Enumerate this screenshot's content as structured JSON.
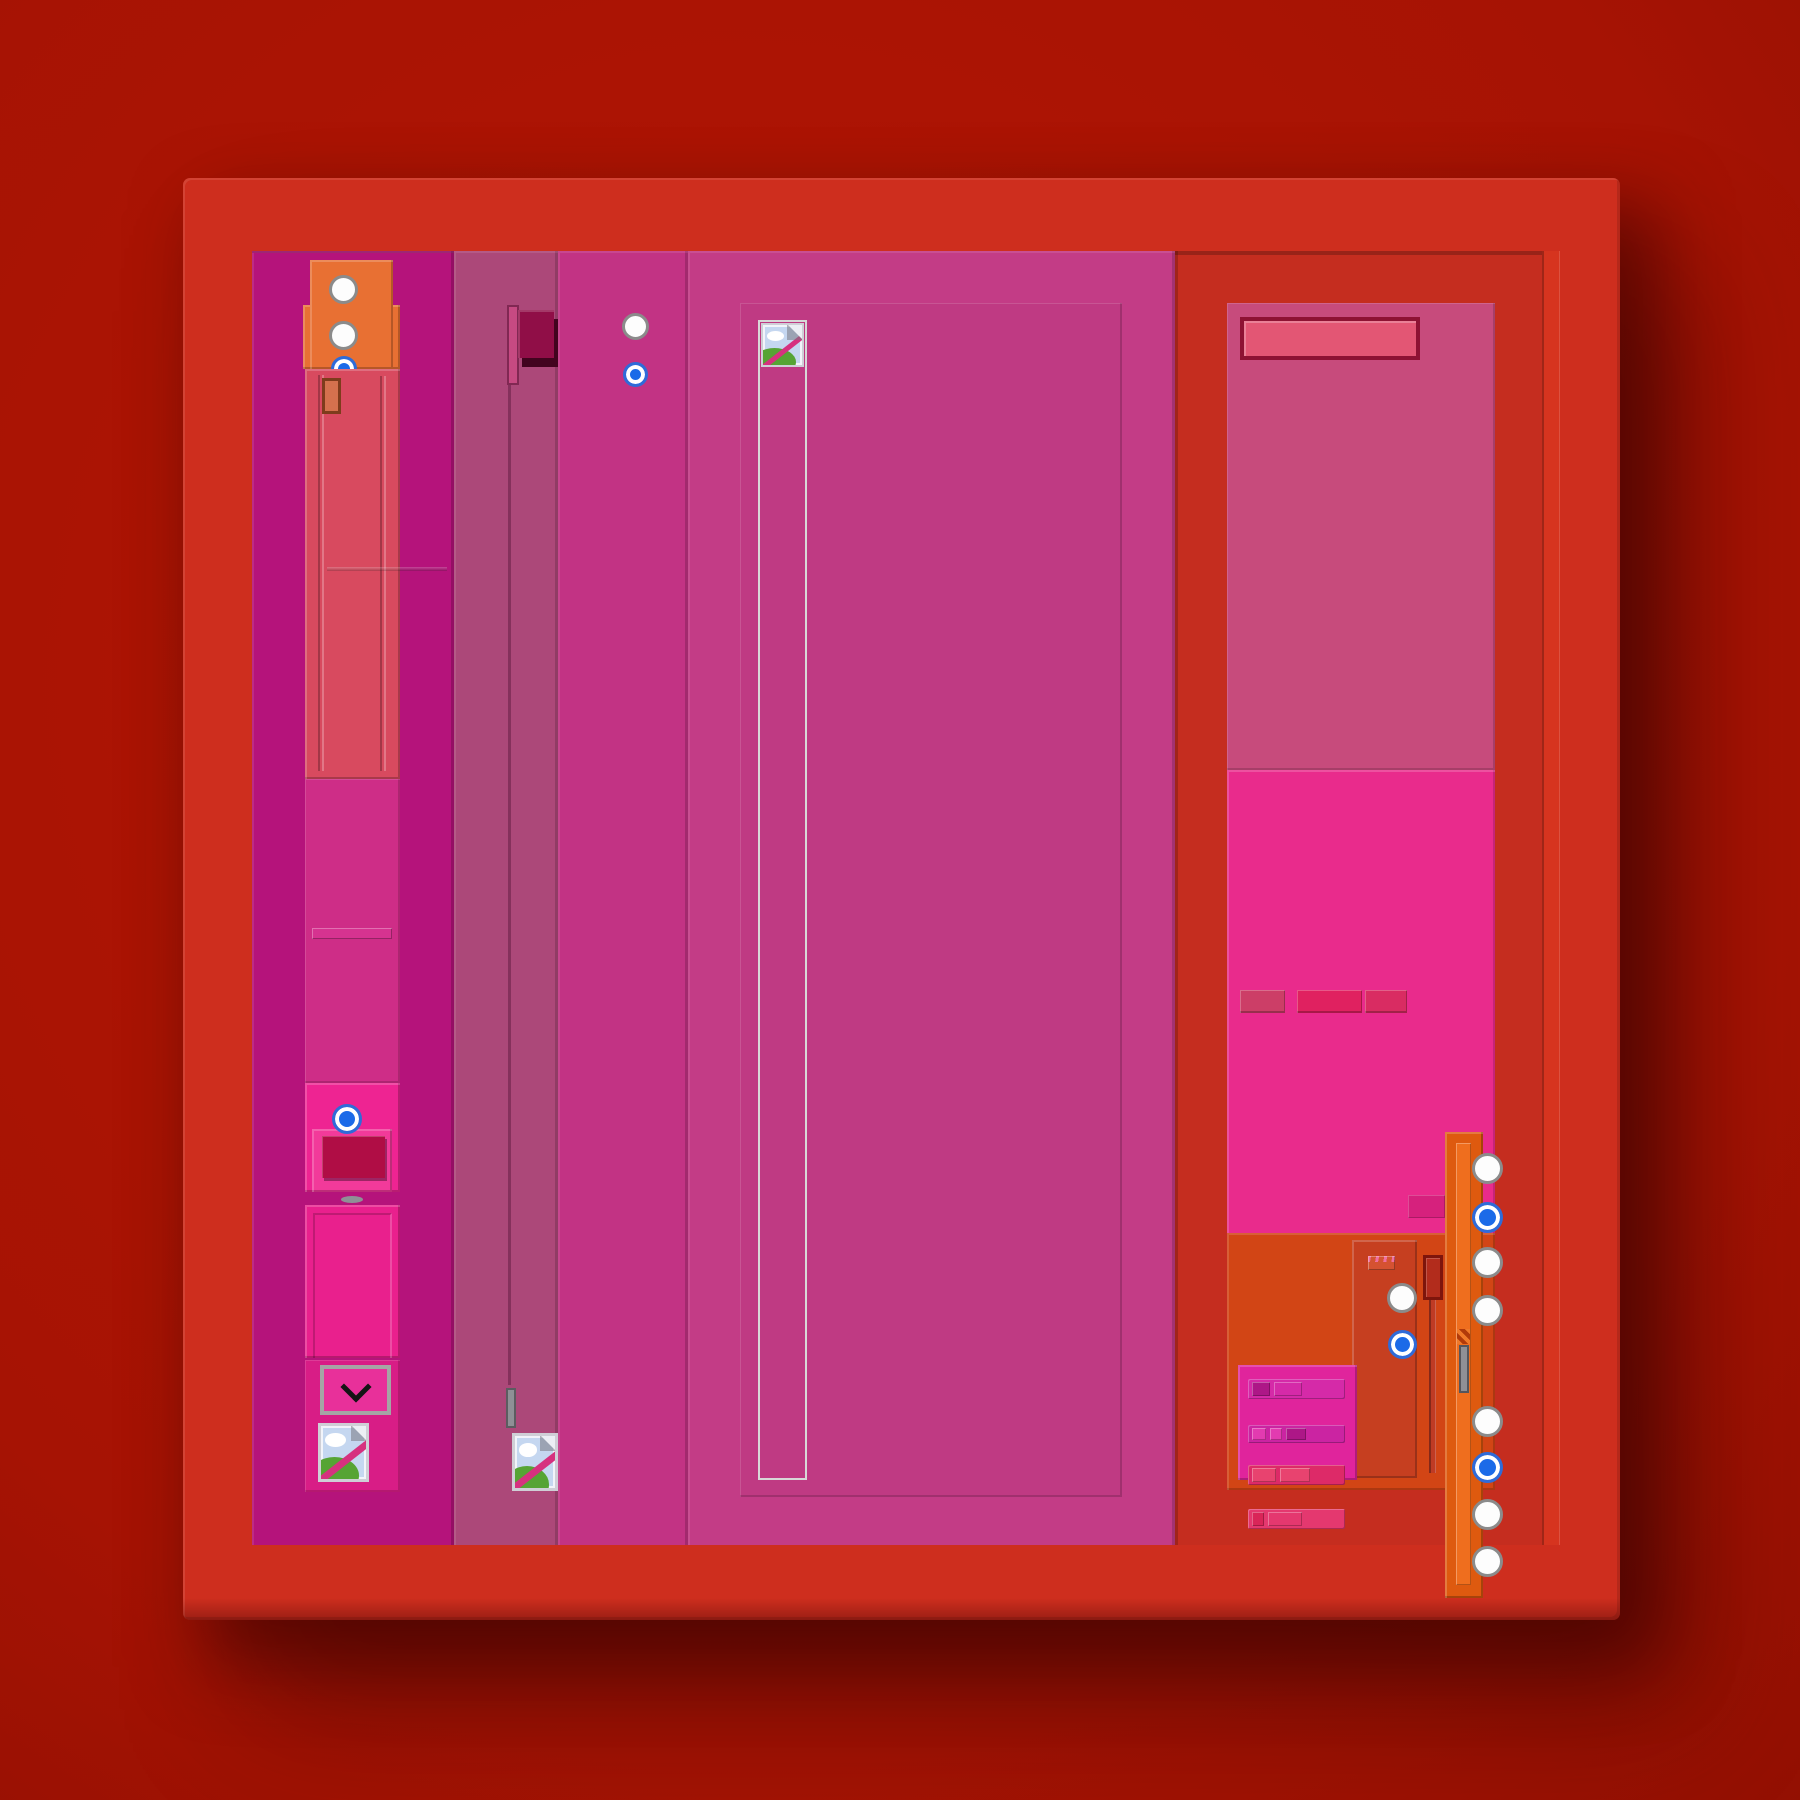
{
  "app": {
    "description": "Themed red-magenta application window mockup with no visible text",
    "palette": {
      "bg-center": "#b41605",
      "bg-edge": "#740a00",
      "frame-red": "#ce2e1e",
      "sidebar-bg": "#b5137b",
      "col2-bg": "#ac4879",
      "col3-bg": "#c23384",
      "main-bg": "#c33c86",
      "main-inset": "#bf3a83",
      "right-red": "#c52d1f",
      "right-strip": "#d6341f",
      "card-top": "#c74b7c",
      "card-mid": "#e92b8c",
      "card-bottom": "#d24515",
      "card-inner": "#c63f20",
      "titlebar": "#e35674",
      "titlebar-border": "#8e1233",
      "seg1": "#cc3e67",
      "seg2": "#e02160",
      "seg3": "#d92c62",
      "tab-pink": "#d6217d",
      "sidebar-card": "#d84a5f",
      "orange-block": "#e87033",
      "orange-rect": "#d4714e",
      "orange-rect-border": "#7e3c1c",
      "magenta-block": "#ce2d87",
      "divider-pink": "#d63390",
      "button-outer": "#ee2492",
      "button-frame": "#f23a9a",
      "button-face": "#b00d45",
      "pink-panel": "#e9208d",
      "bottom-container": "#d81d86",
      "dropdown-pink": "#e8309a",
      "dropdown-border": "#a5a5a5",
      "dark-square": "#900e47",
      "square-shadow": "#42041f",
      "light-bar": "#c64a82",
      "handle-gray": "#8f9096",
      "scrollbar-orange": "#de5a0f",
      "scrollbar-inner": "#ef6e1e",
      "slider-dark": "#b22c1c",
      "slider-border": "#7e150c",
      "listbox": "#e0249c",
      "row1": "#d52aa8",
      "row1-seg": "#ad1787",
      "row2": "#cb24a2",
      "row2-seg": "#e23bb0",
      "row3": "#dd2a68",
      "row3-seg": "#e8436f",
      "row4": "#e4386f",
      "row4-seg": "#d92558",
      "radio-blue": "#1b6ae8",
      "radio-ring": "#2f6bd8",
      "radio-border": "#8b8b8b",
      "icon-sky": "#c5d7f0",
      "icon-hill": "#56a434",
      "icon-slash": "#d6317f",
      "striped-rect": "#d55231",
      "striped-marks": "#f06fa0"
    }
  },
  "icons": [
    "broken-image-icon",
    "chevron-down-icon",
    "radio-button",
    "slider-handle"
  ],
  "sidebar": {
    "top_radios": [
      {
        "state": "unselected"
      },
      {
        "state": "unselected"
      }
    ],
    "peek_radio": {
      "state": "selected"
    },
    "button_radio": {
      "state": "selected"
    }
  },
  "column3": {
    "radios": [
      {
        "state": "unselected"
      },
      {
        "state": "selected"
      }
    ]
  },
  "right_inner_card": {
    "radios": [
      {
        "state": "unselected"
      },
      {
        "state": "selected"
      }
    ]
  },
  "right_rail": {
    "radios": [
      {
        "state": "unselected"
      },
      {
        "state": "selected"
      },
      {
        "state": "unselected"
      },
      {
        "state": "unselected"
      },
      {
        "state": "unselected"
      },
      {
        "state": "selected"
      },
      {
        "state": "unselected"
      },
      {
        "state": "unselected"
      }
    ]
  }
}
